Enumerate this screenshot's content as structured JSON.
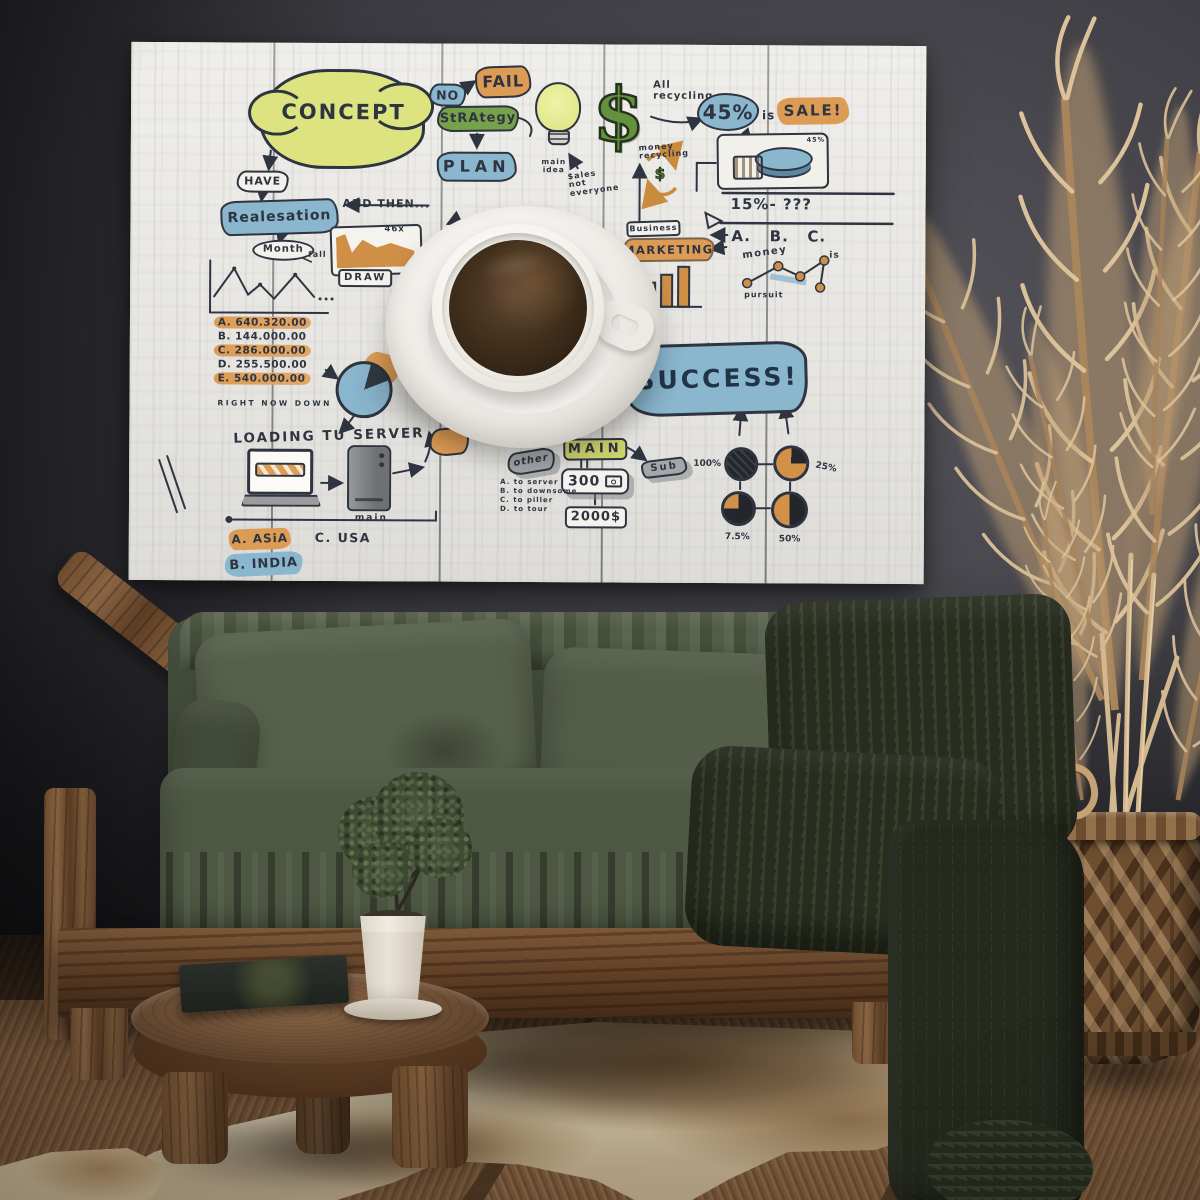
{
  "palette": {
    "ink": "#2e3440",
    "highlight_yellow": "#dde47f",
    "highlight_blue": "#8ab6ce",
    "highlight_orange": "#dd9c55",
    "highlight_green": "#76a24b",
    "canvas": "#e9e8e4",
    "wall": "#434248",
    "sofa_green": "#4c5541",
    "blanket_green": "#38402d",
    "wood_brown": "#7a5638",
    "floor_brown": "#6e4e33",
    "rug_beige": "#c3ae8a",
    "pampas_tan": "#c2a077"
  },
  "artwork": {
    "concept": "CONCEPT",
    "have": "HAVE",
    "realisation": "Realesation",
    "month": "Month",
    "fall": "fall",
    "and_then": "AND THEN...",
    "no": "NO",
    "fail": "FAIL",
    "strategy": "StRAtegy",
    "plan": "PLAN",
    "chart_callout": "46x",
    "draw": "DRAW",
    "amounts": [
      "A. 640.320.00",
      "B. 144.000.00",
      "C. 286.000.00",
      "D. 255.500.00",
      "E. 540.000.00"
    ],
    "right_now_down": "RIGHT NOW DOWN",
    "loading_server": "LOADING TU SERVER",
    "server_caption": "main",
    "region_a": "A. ASiA",
    "region_c": "C. USA",
    "region_b": "B. INDIA",
    "main_idea": "main idea",
    "sales_note": "$ales not everyone",
    "dollar": "$",
    "all_recycling": "All recycling",
    "money_recycling": "money recycling",
    "recycle_dollar": "$",
    "pct45": "45%",
    "is_word": "is",
    "sale": "SALE!",
    "pie_callout": "45%",
    "question_line": "15%- ???",
    "abc": "A.   B.   C.",
    "money_word": "money",
    "is_small": "is",
    "pursuit_word": "pursuit",
    "business": "Business",
    "marketing": "MARKETING",
    "other": "other",
    "main_box": "MAIN",
    "num_300": "300",
    "num_2000": "2000$",
    "sub": "Sub",
    "success": "SUCCESS!",
    "pies": [
      {
        "label": "100%",
        "value": 100
      },
      {
        "label": "25%",
        "value": 25
      },
      {
        "label": "7.5%",
        "value": 75
      },
      {
        "label": "50%",
        "value": 50
      }
    ],
    "notes": [
      "A. to server",
      "B. to downsome",
      "C. to piller",
      "D. to tour"
    ]
  }
}
